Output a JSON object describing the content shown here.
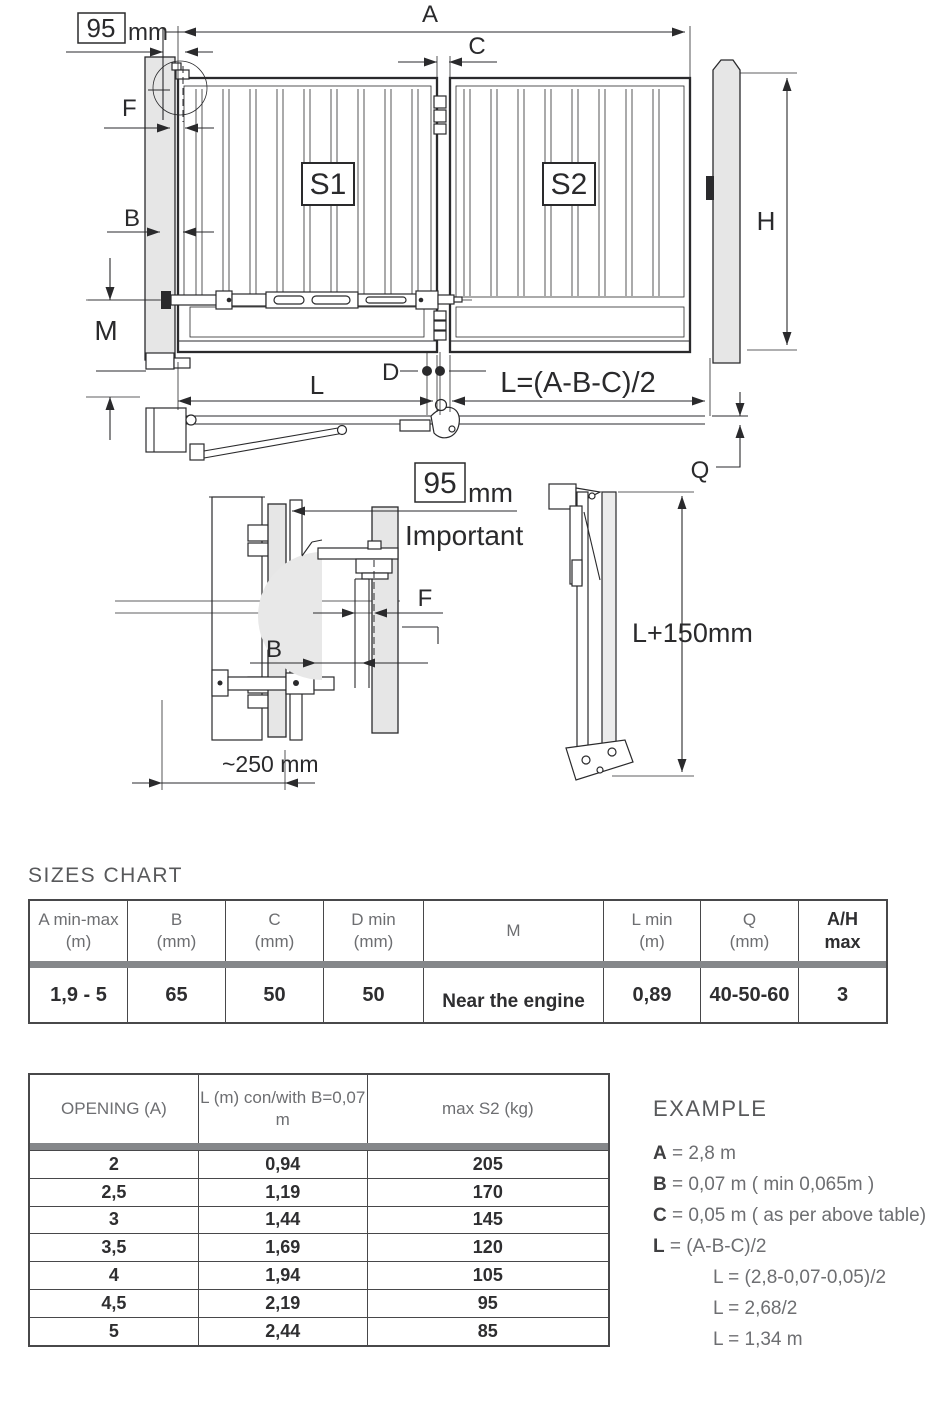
{
  "diagram": {
    "offset_box": {
      "value": "95",
      "unit": "mm"
    },
    "labels": {
      "a": "A",
      "b": "B",
      "c": "C",
      "d": "D",
      "f": "F",
      "h": "H",
      "l": "L",
      "m": "M",
      "q": "Q"
    },
    "leaf_left": "S1",
    "leaf_right": "S2",
    "formula": "L=(A-B-C)/2",
    "important_note": "Important",
    "arm_total_length": "L+150mm",
    "lateral_distance": "~250 mm"
  },
  "sizes_chart": {
    "title": "SIZES CHART",
    "headers": [
      [
        "A min-max",
        "(m)"
      ],
      [
        "B",
        "(mm)"
      ],
      [
        "C",
        "(mm)"
      ],
      [
        "D min",
        "(mm)"
      ],
      [
        "M",
        ""
      ],
      [
        "L min",
        "(m)"
      ],
      [
        "Q",
        "(mm)"
      ],
      [
        "A/H",
        "max"
      ]
    ],
    "row": [
      "1,9 - 5",
      "65",
      "50",
      "50",
      "Near the engine",
      "0,89",
      "40-50-60",
      "3"
    ]
  },
  "opening_table": {
    "headers": [
      "OPENING (A)",
      "L (m) con/with B=0,07 m",
      "max S2 (kg)"
    ],
    "rows": [
      [
        "2",
        "0,94",
        "205"
      ],
      [
        "2,5",
        "1,19",
        "170"
      ],
      [
        "3",
        "1,44",
        "145"
      ],
      [
        "3,5",
        "1,69",
        "120"
      ],
      [
        "4",
        "1,94",
        "105"
      ],
      [
        "4,5",
        "2,19",
        "95"
      ],
      [
        "5",
        "2,44",
        "85"
      ]
    ]
  },
  "example": {
    "title": "EXAMPLE",
    "lines": [
      {
        "bold": "A",
        "rest": " = 2,8 m",
        "indent": false
      },
      {
        "bold": "B",
        "rest": " = 0,07 m ( min 0,065m )",
        "indent": false
      },
      {
        "bold": "C",
        "rest": " = 0,05 m ( as per above table)",
        "indent": false
      },
      {
        "bold": "L",
        "rest": " = (A-B-C)/2",
        "indent": false
      },
      {
        "bold": "",
        "rest": "L = (2,8-0,07-0,05)/2",
        "indent": true
      },
      {
        "bold": "",
        "rest": "L = 2,68/2",
        "indent": true
      },
      {
        "bold": "",
        "rest": "L = 1,34 m",
        "indent": true
      }
    ]
  },
  "colors": {
    "ink": "#2a2a2c",
    "post_fill": "#e6e6e6",
    "divider": "#85878a",
    "heading": "#58595b",
    "header_text": "#6d6e71"
  }
}
